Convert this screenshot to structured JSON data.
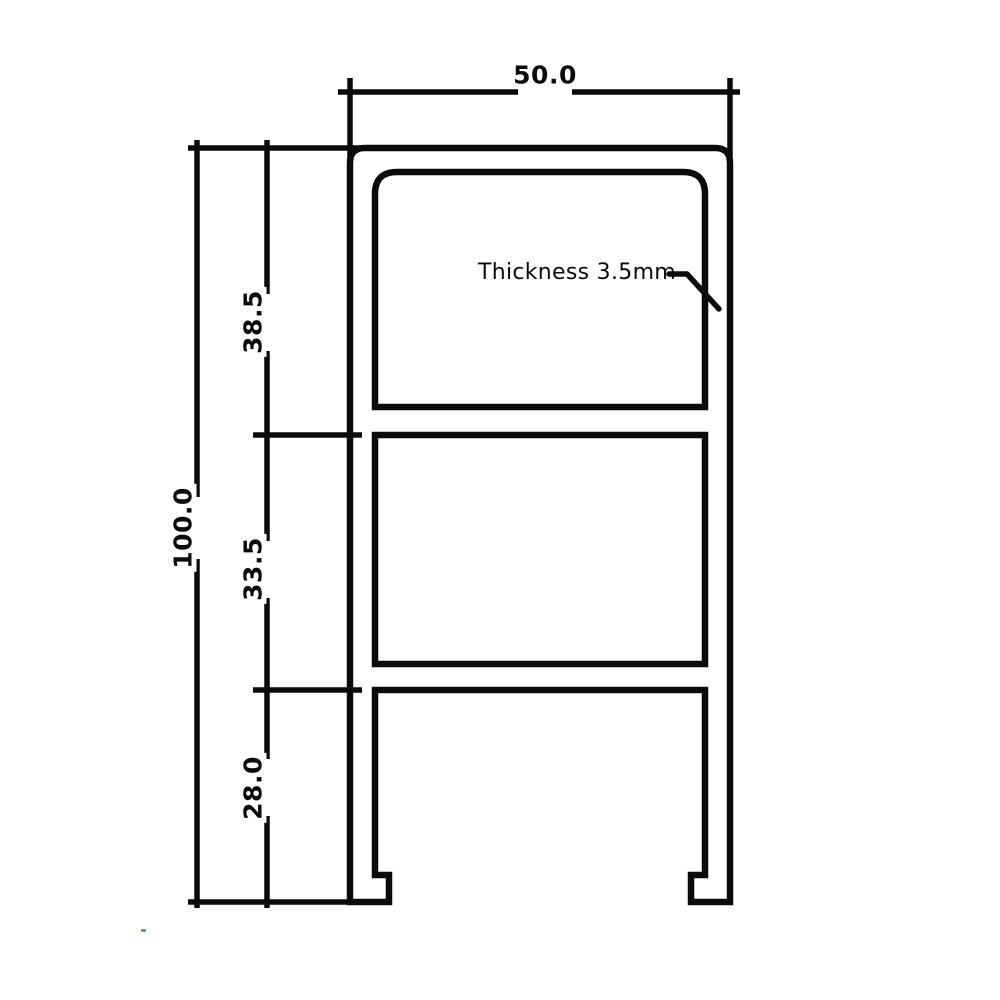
{
  "colors": {
    "line": "#0b0b0b",
    "background": "#ffffff"
  },
  "dimensions": {
    "width_label": "50.0",
    "overall_height_label": "100.0",
    "segment_labels": {
      "top": "38.5",
      "middle": "33.5",
      "bottom": "28.0"
    }
  },
  "annotation": {
    "thickness_label": "Thickness 3.5mm"
  }
}
